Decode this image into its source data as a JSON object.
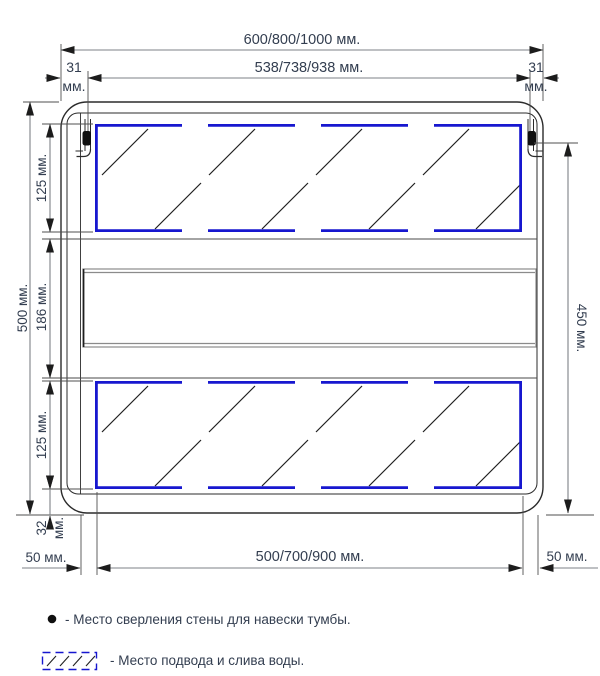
{
  "colors": {
    "accent_blue": "#1717cf",
    "drawing_line": "#2b2b2b",
    "dimension_line": "#7d8287",
    "text": "#333e50"
  },
  "dimensions": {
    "top_total": "600/800/1000 мм.",
    "top_inner": "538/738/938 мм.",
    "side_offset_left": "31",
    "side_offset_left_unit": "мм.",
    "side_offset_right": "31",
    "side_offset_right_unit": "мм.",
    "left_total": "500 мм.",
    "left_zone_top": "125 мм.",
    "left_zone_middle": "186 мм.",
    "left_zone_bottom": "125 мм.",
    "left_bottom_gap": "32",
    "left_bottom_gap_unit": "мм.",
    "right_height": "450 мм.",
    "bottom_inner": "500/700/900 мм.",
    "bottom_offset_left": "50 мм.",
    "bottom_offset_right": "50 мм."
  },
  "legend": {
    "drill_point_text": "- Место сверления стены для навески тумбы.",
    "water_zone_text": "- Место подвода и слива воды."
  }
}
